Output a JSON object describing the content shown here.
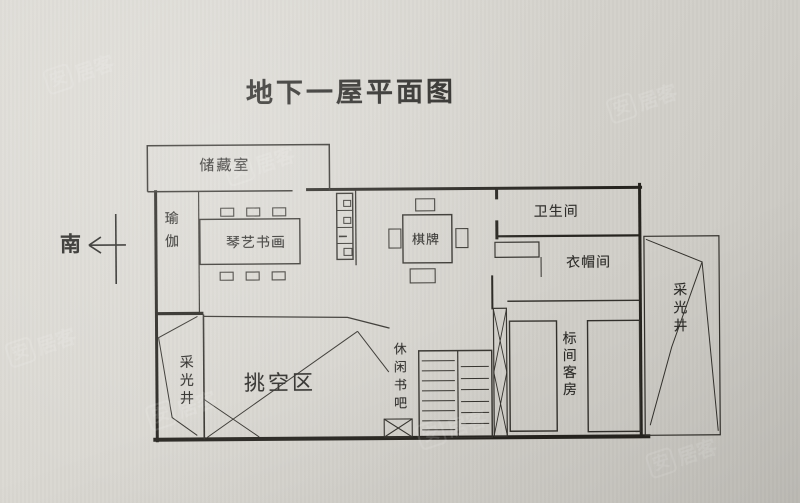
{
  "colors": {
    "paper": "#d8d6d0",
    "wall_line": "#26241f",
    "thin_line": "#38362f",
    "text": "#2b2a27"
  },
  "title": "地下一屋平面图",
  "compass": {
    "direction_label": "南"
  },
  "rooms": {
    "storage": "储藏室",
    "yoga": "瑜伽",
    "piano_art": "琴艺书画",
    "chess": "棋牌",
    "bathroom": "卫生间",
    "cloakroom": "衣帽间",
    "lightwell_right": "采光井",
    "lightwell_left": "采光井",
    "void_area": "挑空区",
    "book_bar": "休闲书吧",
    "guest_room": "标间客房"
  },
  "watermark": {
    "logo_char": "安",
    "text": "居客"
  }
}
